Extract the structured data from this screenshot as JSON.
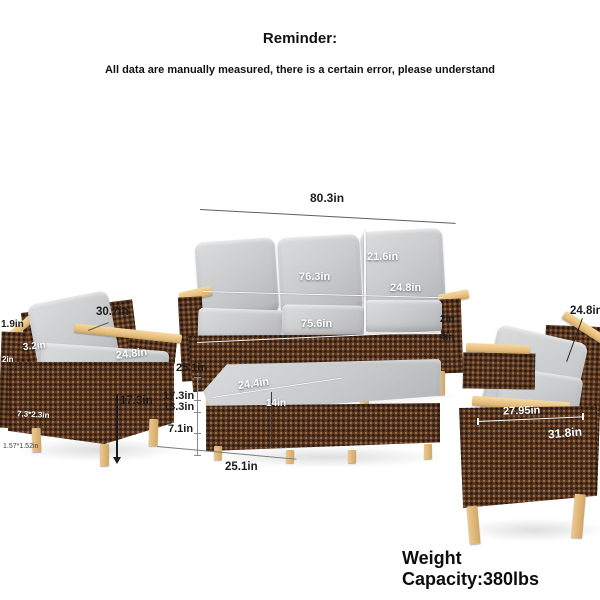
{
  "header": {
    "title": "Reminder:",
    "subtitle": "All data are manually measured, there is a certain error, please understand"
  },
  "footer": {
    "weight_capacity": "Weight Capacity:380lbs"
  },
  "labels": {
    "sofa": {
      "overall_width": "80.3in",
      "back_cushion_width": "76.3in",
      "back_cushion_height": "21.6in",
      "cushion_depth": "24.8in",
      "seat_width": "75.6in",
      "partial_right_top": "2in",
      "partial_right_bottom": "4in"
    },
    "left_chair": {
      "frame_thickness": "1.9in",
      "back_cushion_thickness": "3.2in",
      "overall_width": "30.7in",
      "seat_depth": "24.8in",
      "side_fragment": "2in",
      "leg_height": "17.3in",
      "armrest_size": "7.3*2.3in",
      "leg_size": "1.57*1.52in"
    },
    "ottoman": {
      "top_depth": "25.1in",
      "overall_height": "17.3in",
      "cushion_top_height": "13.3in",
      "base_height": "7.1in",
      "top_width": "24.4in",
      "inner_width": "14in",
      "front_width": "25.1in"
    },
    "right_chair": {
      "back_cushion_height": "24.8in",
      "armrest_length": "27.95in",
      "overall_depth": "31.8in"
    }
  },
  "colors": {
    "wicker": "#5b3a24",
    "wood": "#e7c088",
    "cushion": "#c7c9cb",
    "background": "#ffffff",
    "label_dark": "#1b1b1b",
    "label_light": "#ffffff"
  }
}
